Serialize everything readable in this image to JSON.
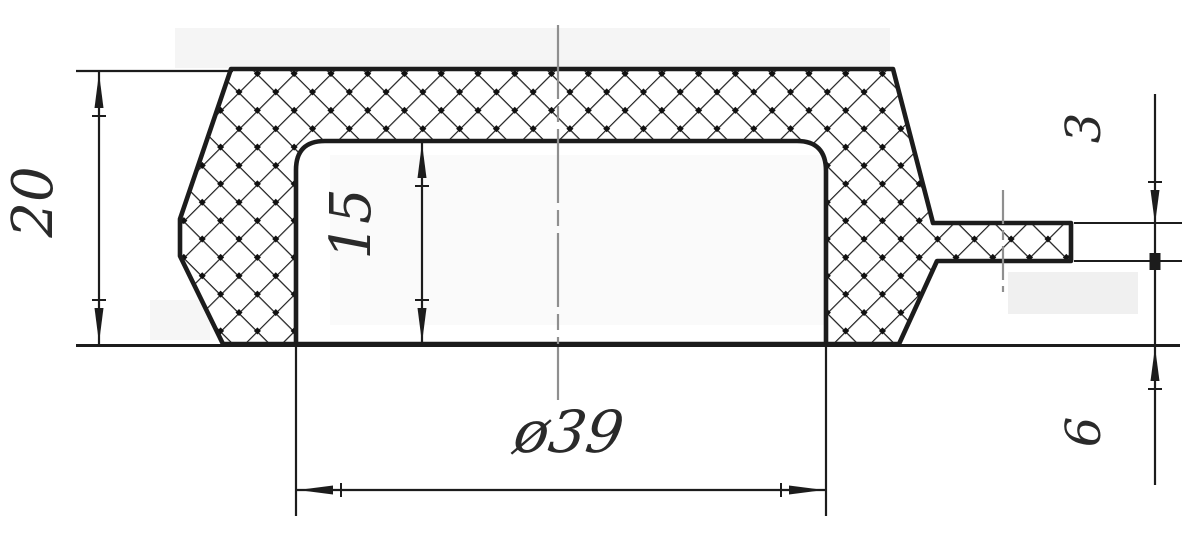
{
  "drawing": {
    "description": "cross-section technical drawing of a hollow cap with side stem",
    "dimension_labels": {
      "overall_height": "20",
      "cavity_depth": "15",
      "stem_thickness": "3",
      "rim_height": "6",
      "cavity_diameter": "ø39"
    },
    "colors": {
      "line": "#1c1c1c",
      "centerline": "#8f8f8f",
      "background": "#ffffff"
    }
  }
}
